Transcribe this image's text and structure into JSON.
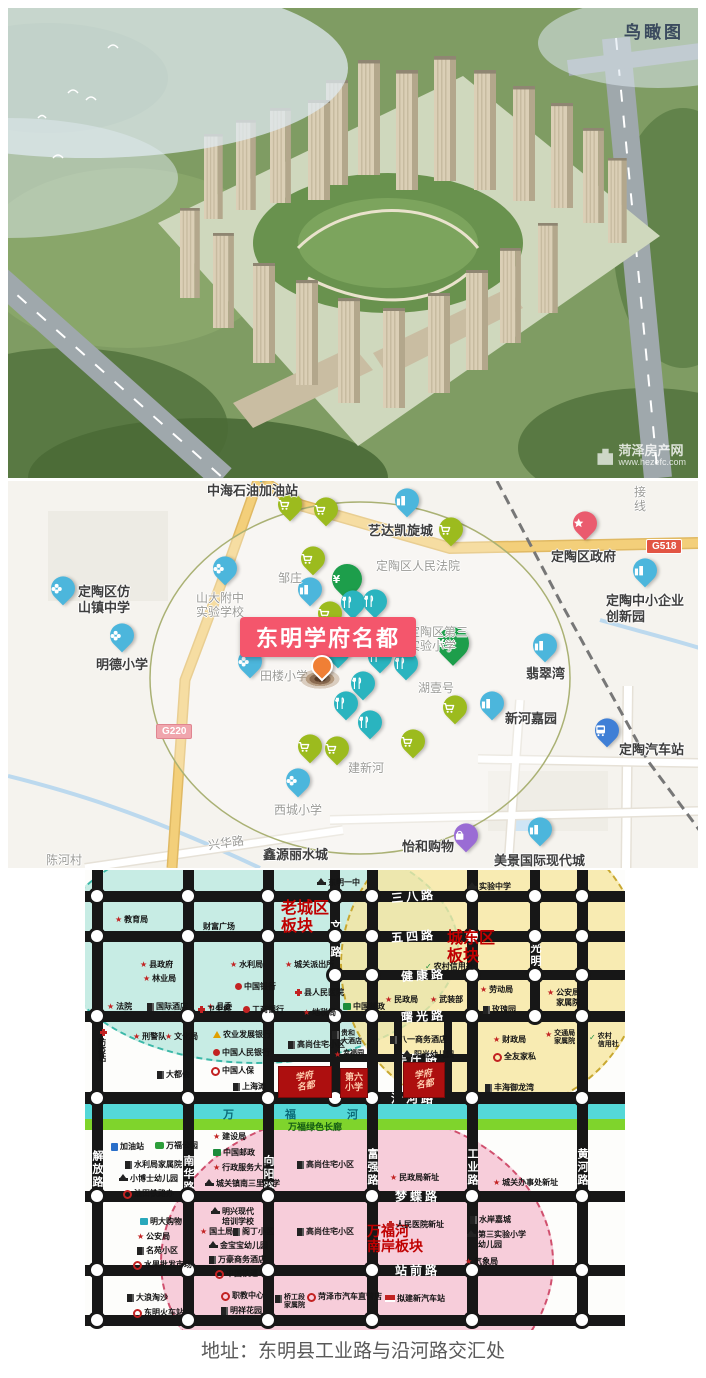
{
  "page": {
    "address_caption": "地址：东明县工业路与沿河路交汇处"
  },
  "aerial": {
    "corner_label": "鸟瞰图",
    "watermark_line1": "菏泽房产网",
    "watermark_line2": "www.hezefc.com"
  },
  "location_map": {
    "project_label": "东明学府名都",
    "project_label_pos": {
      "x": 232,
      "y": 136
    },
    "marker": {
      "x": 314,
      "y": 196
    },
    "pins": [
      {
        "t": "text",
        "x": 199,
        "y": 2,
        "l": "中海石油加油站",
        "cls": "big"
      },
      {
        "t": "place",
        "x": 253,
        "y": -6
      },
      {
        "t": "school",
        "x": 55,
        "y": 117,
        "l": "定陶区仿\n山镇中学",
        "lx": 70,
        "ly": 103,
        "cls": "big"
      },
      {
        "t": "school",
        "x": 114,
        "y": 164,
        "l": "明德小学",
        "lx": 88,
        "ly": 176,
        "cls": "big"
      },
      {
        "t": "school",
        "x": 217,
        "y": 97
      },
      {
        "t": "text",
        "x": 188,
        "y": 110,
        "l": "山大附中\n实验学校",
        "cls": "dim"
      },
      {
        "t": "text",
        "x": 270,
        "y": 90,
        "l": "邹庄",
        "cls": "dim"
      },
      {
        "t": "place",
        "x": 302,
        "y": 118
      },
      {
        "t": "school",
        "x": 242,
        "y": 190,
        "l": "田楼小学",
        "lx": 252,
        "ly": 188,
        "cls": "dim"
      },
      {
        "t": "place",
        "x": 399,
        "y": 29,
        "l": "艺达凯旋城",
        "lx": 360,
        "ly": 42,
        "cls": "big"
      },
      {
        "t": "text",
        "x": 368,
        "y": 78,
        "l": "定陶区人民法院",
        "cls": "dim"
      },
      {
        "t": "gov",
        "x": 577,
        "y": 52,
        "l": "定陶区政府",
        "lx": 543,
        "ly": 68,
        "cls": "big"
      },
      {
        "t": "badge",
        "x": 638,
        "y": 58,
        "l": "G518",
        "cls": "g518"
      },
      {
        "t": "text",
        "x": 626,
        "y": 4,
        "l": "接\n线",
        "cls": "dim"
      },
      {
        "t": "place",
        "x": 637,
        "y": 99,
        "l": "定陶中小企业\n创新园",
        "lx": 598,
        "ly": 112,
        "cls": "big"
      },
      {
        "t": "place",
        "x": 537,
        "y": 174,
        "l": "翡翠湾",
        "lx": 518,
        "ly": 185,
        "cls": "big"
      },
      {
        "t": "text",
        "x": 400,
        "y": 144,
        "l": "定陶区第三\n实验小学",
        "cls": "dim"
      },
      {
        "t": "yen",
        "x": 445,
        "y": 175,
        "s": 32
      },
      {
        "t": "yen",
        "x": 339,
        "y": 110,
        "s": 30
      },
      {
        "t": "text",
        "x": 410,
        "y": 200,
        "l": "湖壹号",
        "cls": "dim"
      },
      {
        "t": "place",
        "x": 484,
        "y": 232,
        "l": "新河嘉园",
        "lx": 497,
        "ly": 230,
        "cls": "big"
      },
      {
        "t": "bus",
        "x": 599,
        "y": 259,
        "l": "定陶汽车站",
        "lx": 611,
        "ly": 261,
        "cls": "big"
      },
      {
        "t": "text",
        "x": 340,
        "y": 280,
        "l": "建新河",
        "cls": "dim"
      },
      {
        "t": "school",
        "x": 290,
        "y": 309,
        "l": "西城小学",
        "lx": 266,
        "ly": 322,
        "cls": "dim"
      },
      {
        "t": "badge",
        "x": 148,
        "y": 243,
        "l": "G220",
        "cls": "g220"
      },
      {
        "t": "text",
        "x": 200,
        "y": 355,
        "l": "兴华路",
        "cls": "dim",
        "rot": -8
      },
      {
        "t": "text",
        "x": 255,
        "y": 366,
        "l": "鑫源丽水城",
        "cls": "big"
      },
      {
        "t": "mall",
        "x": 458,
        "y": 364,
        "l": "怡和购物",
        "lx": 394,
        "ly": 358,
        "cls": "big"
      },
      {
        "t": "place",
        "x": 532,
        "y": 358,
        "l": "美景国际现代城",
        "lx": 486,
        "ly": 372,
        "cls": "big"
      },
      {
        "t": "text",
        "x": 38,
        "y": 372,
        "l": "陈河村",
        "cls": "dim"
      },
      {
        "t": "cart",
        "x": 282,
        "y": 33
      },
      {
        "t": "cart",
        "x": 318,
        "y": 38
      },
      {
        "t": "cart",
        "x": 305,
        "y": 87
      },
      {
        "t": "cart",
        "x": 322,
        "y": 142
      },
      {
        "t": "cart",
        "x": 443,
        "y": 58
      },
      {
        "t": "cart",
        "x": 447,
        "y": 236
      },
      {
        "t": "cart",
        "x": 302,
        "y": 275
      },
      {
        "t": "cart",
        "x": 329,
        "y": 277
      },
      {
        "t": "cart",
        "x": 405,
        "y": 270
      },
      {
        "t": "food",
        "x": 345,
        "y": 131
      },
      {
        "t": "food",
        "x": 367,
        "y": 130
      },
      {
        "t": "food",
        "x": 352,
        "y": 165
      },
      {
        "t": "food",
        "x": 330,
        "y": 180
      },
      {
        "t": "food",
        "x": 372,
        "y": 185
      },
      {
        "t": "food",
        "x": 398,
        "y": 192
      },
      {
        "t": "food",
        "x": 355,
        "y": 212
      },
      {
        "t": "food",
        "x": 338,
        "y": 232
      },
      {
        "t": "food",
        "x": 362,
        "y": 251
      }
    ]
  },
  "planning_map": {
    "zones": [
      {
        "x": -30,
        "y": -40,
        "w": 400,
        "h": 230,
        "fill": "rgba(180,230,220,0.75)",
        "border": "#3bb8a8"
      },
      {
        "x": 255,
        "y": -55,
        "w": 300,
        "h": 295,
        "fill": "rgba(246,230,160,0.8)",
        "border": "#c8a830"
      },
      {
        "x": 75,
        "y": 240,
        "w": 390,
        "h": 300,
        "fill": "rgba(246,196,212,0.85)",
        "border": "#d0506e"
      }
    ],
    "zone_labels": [
      {
        "text": "老城区\n板块",
        "x": 196,
        "y": 30,
        "fs": 16
      },
      {
        "text": "城东区\n板块",
        "x": 362,
        "y": 60,
        "fs": 16
      },
      {
        "text": "万福河\n南岸板块",
        "x": 282,
        "y": 354,
        "fs": 14
      }
    ],
    "roads_h": [
      {
        "y": 26,
        "x1": 0,
        "x2": 540,
        "w": 11,
        "l": "三八路",
        "lx": 306,
        "rot": -5
      },
      {
        "y": 66,
        "x1": 0,
        "x2": 540,
        "w": 11,
        "l": "五四路",
        "lx": 306,
        "rot": -4
      },
      {
        "y": 105,
        "x1": 248,
        "x2": 540,
        "w": 10,
        "l": "健康路",
        "lx": 316,
        "rot": -4
      },
      {
        "y": 146,
        "x1": 0,
        "x2": 540,
        "w": 11,
        "l": "曙光路",
        "lx": 316,
        "rot": -3
      },
      {
        "y": 188,
        "x1": 183,
        "x2": 392,
        "w": 8,
        "l": "吴庄路",
        "lx": 310,
        "dot": false
      },
      {
        "y": 228,
        "x1": 0,
        "x2": 540,
        "w": 12,
        "l": "沿河路",
        "lx": 306
      },
      {
        "y": 326,
        "x1": 0,
        "x2": 540,
        "w": 11,
        "l": "梦蝶路",
        "lx": 310
      },
      {
        "y": 400,
        "x1": 0,
        "x2": 540,
        "w": 11,
        "l": "站前路",
        "lx": 310
      },
      {
        "y": 450,
        "x1": 0,
        "x2": 540,
        "w": 11
      }
    ],
    "roads_v": [
      {
        "x": 12,
        "y1": 0,
        "y2": 455,
        "w": 11,
        "l": "解放路",
        "ly": 280
      },
      {
        "x": 103,
        "y1": 0,
        "y2": 455,
        "w": 11,
        "l": "南华路",
        "ly": 285
      },
      {
        "x": 183,
        "y1": 0,
        "y2": 455,
        "w": 11,
        "l": "向阳路",
        "ly": 285
      },
      {
        "x": 250,
        "y1": 0,
        "y2": 234,
        "w": 10,
        "l": "文化路",
        "ly": 50
      },
      {
        "x": 287,
        "y1": 0,
        "y2": 455,
        "w": 11,
        "l": "富强路",
        "ly": 278
      },
      {
        "x": 387,
        "y1": 0,
        "y2": 455,
        "w": 11,
        "l": "工业路",
        "ly": 278
      },
      {
        "x": 450,
        "y1": 0,
        "y2": 146,
        "w": 10,
        "l": "光明路",
        "ly": 72
      },
      {
        "x": 497,
        "y1": 0,
        "y2": 455,
        "w": 11,
        "l": "黄河路",
        "ly": 278
      },
      {
        "x": 313,
        "y1": 146,
        "y2": 234,
        "w": 8,
        "dot": false
      },
      {
        "x": 363,
        "y1": 146,
        "y2": 234,
        "w": 8,
        "dot": false
      }
    ],
    "river": {
      "stripes": [
        {
          "y": 234,
          "h": 15,
          "color": "#54d8d8"
        },
        {
          "y": 249,
          "h": 11,
          "color": "#7fd42c"
        }
      ],
      "chars": [
        {
          "t": "万",
          "x": 138,
          "y": 236
        },
        {
          "t": "福",
          "x": 200,
          "y": 236
        },
        {
          "t": "河",
          "x": 262,
          "y": 236
        }
      ],
      "corridor": {
        "t": "万福绿色长廊",
        "x": 203,
        "y": 250
      }
    },
    "blocks": [
      {
        "x": 193,
        "y": 196,
        "w": 52,
        "h": 30,
        "t": "学府\n名都",
        "cls": "xf"
      },
      {
        "x": 255,
        "y": 198,
        "w": 26,
        "h": 28,
        "t": "第六\n小学",
        "cls": "six"
      },
      {
        "x": 318,
        "y": 192,
        "w": 40,
        "h": 34,
        "t": "学府\n名都",
        "cls": "xf"
      }
    ],
    "pois": [
      {
        "x": 30,
        "y": 45,
        "i": "star",
        "t": "教育局"
      },
      {
        "x": 118,
        "y": 52,
        "i": "none",
        "t": "财富广场"
      },
      {
        "x": 232,
        "y": 8,
        "i": "cap",
        "t": "东明一中"
      },
      {
        "x": 383,
        "y": 12,
        "i": "cap",
        "t": "实验中学"
      },
      {
        "x": 55,
        "y": 90,
        "i": "star",
        "t": "县政府"
      },
      {
        "x": 58,
        "y": 104,
        "i": "star",
        "t": "林业局"
      },
      {
        "x": 22,
        "y": 132,
        "i": "star",
        "t": "法院"
      },
      {
        "x": 62,
        "y": 132,
        "i": "bldg",
        "t": "国际酒店"
      },
      {
        "x": 122,
        "y": 132,
        "i": "star",
        "t": "县委"
      },
      {
        "x": 145,
        "y": 90,
        "i": "star",
        "t": "水利局"
      },
      {
        "x": 200,
        "y": 90,
        "i": "star",
        "t": "城关派出所"
      },
      {
        "x": 150,
        "y": 112,
        "i": "reddot",
        "t": "中国银行"
      },
      {
        "x": 113,
        "y": 135,
        "i": "cross",
        "t": "卫生局"
      },
      {
        "x": 158,
        "y": 135,
        "i": "reddot",
        "t": "工商银行"
      },
      {
        "x": 210,
        "y": 118,
        "i": "cross",
        "t": "县人民医院"
      },
      {
        "x": 218,
        "y": 138,
        "i": "star",
        "t": "地税局"
      },
      {
        "x": 258,
        "y": 132,
        "i": "post",
        "t": "中国邮政"
      },
      {
        "x": 340,
        "y": 92,
        "i": "check",
        "t": "农村信用社"
      },
      {
        "x": 300,
        "y": 125,
        "i": "star",
        "t": "民政局"
      },
      {
        "x": 345,
        "y": 125,
        "i": "star",
        "t": "武装部"
      },
      {
        "x": 395,
        "y": 115,
        "i": "star",
        "t": "劳动局"
      },
      {
        "x": 398,
        "y": 135,
        "i": "bldg",
        "t": "玫瑰园"
      },
      {
        "x": 462,
        "y": 118,
        "i": "star",
        "t": "公安局\n家属院"
      },
      {
        "x": 12,
        "y": 158,
        "i": "cross",
        "t": "防疫站",
        "cls": "vert"
      },
      {
        "x": 48,
        "y": 162,
        "i": "star",
        "t": "刑警队"
      },
      {
        "x": 80,
        "y": 162,
        "i": "star",
        "t": "文化局"
      },
      {
        "x": 72,
        "y": 200,
        "i": "bldg",
        "t": "大都会"
      },
      {
        "x": 128,
        "y": 160,
        "i": "tri",
        "t": "农业发展银行"
      },
      {
        "x": 128,
        "y": 178,
        "i": "reddot",
        "t": "中国人民银行"
      },
      {
        "x": 126,
        "y": 196,
        "i": "redo",
        "t": "中国人保"
      },
      {
        "x": 148,
        "y": 212,
        "i": "bldg",
        "t": "上海滩"
      },
      {
        "x": 203,
        "y": 170,
        "i": "bldg",
        "t": "高尚住宅小区"
      },
      {
        "x": 247,
        "y": 160,
        "i": "bldg",
        "t": "贵和\n大酒店",
        "fs": 7
      },
      {
        "x": 249,
        "y": 180,
        "i": "star",
        "t": "幸福园",
        "fs": 7
      },
      {
        "x": 305,
        "y": 165,
        "i": "bldg",
        "t": "八一商务酒店"
      },
      {
        "x": 318,
        "y": 180,
        "i": "cap",
        "t": "阳光幼儿园"
      },
      {
        "x": 408,
        "y": 165,
        "i": "star",
        "t": "财政局"
      },
      {
        "x": 408,
        "y": 182,
        "i": "redo",
        "t": "全友家私"
      },
      {
        "x": 460,
        "y": 160,
        "i": "star",
        "t": "交通局\n家属院",
        "fs": 7
      },
      {
        "x": 504,
        "y": 163,
        "i": "check",
        "t": "农村\n信用社",
        "fs": 7
      },
      {
        "x": 400,
        "y": 213,
        "i": "bldg",
        "t": "丰海御龙湾"
      },
      {
        "x": 26,
        "y": 272,
        "i": "pump",
        "t": "加油站"
      },
      {
        "x": 70,
        "y": 271,
        "i": "park",
        "t": "万福公园"
      },
      {
        "x": 128,
        "y": 262,
        "i": "star",
        "t": "建设局"
      },
      {
        "x": 128,
        "y": 278,
        "i": "post",
        "t": "中国邮政"
      },
      {
        "x": 40,
        "y": 290,
        "i": "bldg",
        "t": "水利局家属院"
      },
      {
        "x": 34,
        "y": 304,
        "i": "cap",
        "t": "小博士幼儿园"
      },
      {
        "x": 38,
        "y": 319,
        "i": "redo",
        "t": "油田铁路办"
      },
      {
        "x": 128,
        "y": 293,
        "i": "star",
        "t": "行政服务大厅"
      },
      {
        "x": 120,
        "y": 309,
        "i": "cap",
        "t": "城关镇南三里小学"
      },
      {
        "x": 212,
        "y": 290,
        "i": "bldg",
        "t": "高尚住宅小区"
      },
      {
        "x": 305,
        "y": 303,
        "i": "star",
        "t": "民政局新址"
      },
      {
        "x": 408,
        "y": 308,
        "i": "star",
        "t": "城关办事处新址"
      },
      {
        "x": 55,
        "y": 347,
        "i": "cartT",
        "t": "明大购物"
      },
      {
        "x": 52,
        "y": 362,
        "i": "star",
        "t": "公安局"
      },
      {
        "x": 52,
        "y": 376,
        "i": "bldg",
        "t": "名苑小区"
      },
      {
        "x": 48,
        "y": 390,
        "i": "redo",
        "t": "水果批发市场"
      },
      {
        "x": 126,
        "y": 337,
        "i": "cap",
        "t": "明兴现代\n培训学校"
      },
      {
        "x": 115,
        "y": 357,
        "i": "star",
        "t": "国土局"
      },
      {
        "x": 148,
        "y": 357,
        "i": "bldg",
        "t": "阁丁小区"
      },
      {
        "x": 124,
        "y": 371,
        "i": "cap",
        "t": "金宝宝幼儿园"
      },
      {
        "x": 124,
        "y": 385,
        "i": "bldg",
        "t": "万豪商务酒店"
      },
      {
        "x": 130,
        "y": 399,
        "i": "redo",
        "t": "中国铁通"
      },
      {
        "x": 212,
        "y": 357,
        "i": "bldg",
        "t": "高尚住宅小区"
      },
      {
        "x": 302,
        "y": 350,
        "i": "cross",
        "t": "人民医院新址"
      },
      {
        "x": 385,
        "y": 345,
        "i": "bldg",
        "t": "水岸嘉城"
      },
      {
        "x": 382,
        "y": 360,
        "i": "cap",
        "t": "第三实验小学\n幼儿园"
      },
      {
        "x": 380,
        "y": 387,
        "i": "star",
        "t": "气象局"
      },
      {
        "x": 42,
        "y": 423,
        "i": "bldg",
        "t": "大浪淘沙"
      },
      {
        "x": 48,
        "y": 438,
        "i": "redo",
        "t": "东明火车站"
      },
      {
        "x": 136,
        "y": 421,
        "i": "redo",
        "t": "职教中心"
      },
      {
        "x": 136,
        "y": 436,
        "i": "bldg",
        "t": "明祥花园"
      },
      {
        "x": 190,
        "y": 424,
        "i": "bldg",
        "t": "桥工段\n家属院",
        "fs": 7
      },
      {
        "x": 222,
        "y": 422,
        "i": "redo",
        "t": "菏泽市汽车直营店"
      },
      {
        "x": 300,
        "y": 424,
        "i": "flag",
        "t": "拟建新汽车站"
      }
    ]
  }
}
